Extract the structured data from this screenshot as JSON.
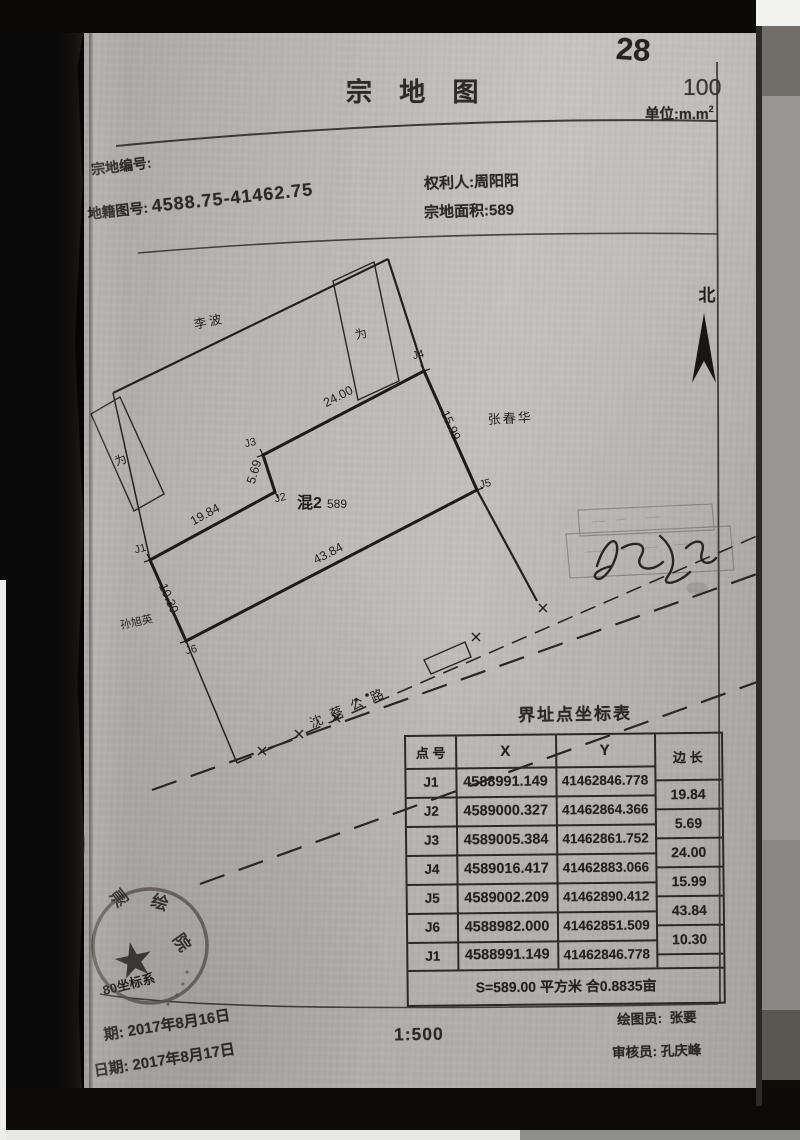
{
  "page": {
    "doc_number": "28",
    "sheet_number": "100",
    "title": "宗 地 图",
    "unit_label": "单位:m.m",
    "unit_sup": "2"
  },
  "header": {
    "parcel_no_label": "宗地编号:",
    "map_no_label": "地籍图号:",
    "map_no_value": "4588.75-41462.75",
    "owner_label": "权利人:",
    "owner_name": "周阳阳",
    "area_label": "宗地面积:",
    "area_value": "589"
  },
  "map": {
    "north": "北",
    "neighbor_top": "李波",
    "neighbor_right": "张春华",
    "neighbor_left": "孙旭英",
    "building_mark_1": "为",
    "building_mark_2": "为",
    "parcel_type": "混2",
    "parcel_area_note": "589",
    "road_name": "沈蔡公路",
    "points": [
      "J1",
      "J2",
      "J3",
      "J4",
      "J5",
      "J6"
    ],
    "dims": {
      "d12": "19.84",
      "d23": "5.69",
      "d34": "24.00",
      "d45": "15.99",
      "d56": "43.84",
      "d61": "10.30"
    },
    "stamp": {
      "star": "★",
      "char_1": "测",
      "char_2": "绘",
      "char_3": "院",
      "coord_system": "80坐标系"
    }
  },
  "table": {
    "title": "界址点坐标表",
    "col_point": "点 号",
    "col_x": "X",
    "col_y": "Y",
    "col_len": "边 长",
    "rows": [
      {
        "p": "J1",
        "x": "4588991.149",
        "y": "41462846.778"
      },
      {
        "p": "J2",
        "x": "4589000.327",
        "y": "41462864.366"
      },
      {
        "p": "J3",
        "x": "4589005.384",
        "y": "41462861.752"
      },
      {
        "p": "J4",
        "x": "4589016.417",
        "y": "41462883.066"
      },
      {
        "p": "J5",
        "x": "4589002.209",
        "y": "41462890.412"
      },
      {
        "p": "J6",
        "x": "4588982.000",
        "y": "41462851.509"
      },
      {
        "p": "J1",
        "x": "4588991.149",
        "y": "41462846.778"
      }
    ],
    "lengths": [
      "19.84",
      "5.69",
      "24.00",
      "15.99",
      "43.84",
      "10.30"
    ],
    "summary": "S=589.00 平方米 合0.8835亩"
  },
  "footer": {
    "scale": "1:500",
    "drafter_label": "绘图员:",
    "drafter_name": "张要",
    "reviewer_label": "审核员:",
    "reviewer_name": "孔庆峰",
    "date_1": "期: 2017年8月16日",
    "date_2": "日期: 2017年8月17日"
  }
}
